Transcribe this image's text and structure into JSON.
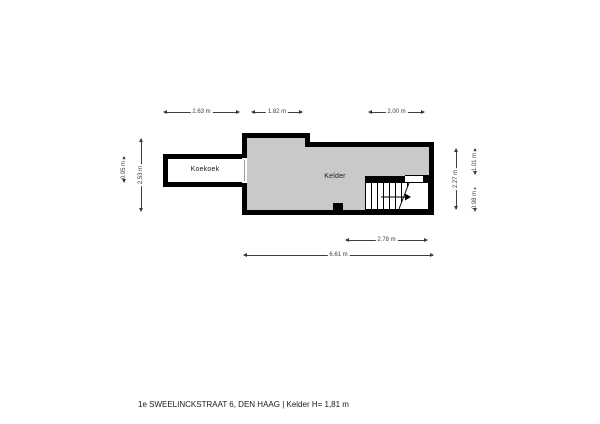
{
  "caption": "1e SWEELINCKSTRAAT 6, DEN HAAG | Kelder H= 1,81 m",
  "rooms": {
    "koekoek": {
      "label": "Koekoek"
    },
    "kelder": {
      "label": "Kelder"
    }
  },
  "dimensions": {
    "koekoek_width": "2.63 m",
    "kelder_left_section_width": "1.82 m",
    "kelder_right_section_width": "2.00 m",
    "koekoek_height": "0.95 m",
    "kelder_left_height": "2.53 m",
    "kelder_right_height": "2.27 m",
    "stair_top_height": "1.01 m",
    "stair_bottom_height": "0.98 m",
    "stair_section_width": "2.78 m",
    "kelder_total_width": "6.61 m"
  },
  "icons": {
    "stair_direction_arrow": "right-arrow"
  },
  "colors": {
    "wall": "#000000",
    "floor": "#c9c9c9",
    "dim": "#3d3d3d",
    "text": "#1a1a1a",
    "background": "#ffffff"
  }
}
